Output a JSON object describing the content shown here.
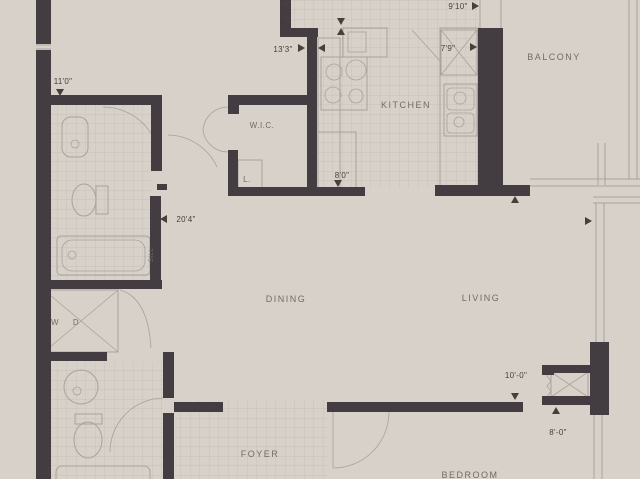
{
  "title": "Apartment floor plan",
  "colors": {
    "background": "#d7d1ca",
    "wall": "#433d41",
    "fixture_line": "#a9a29b",
    "tile_line": "#c3bcb4",
    "room_text": "#716b64",
    "dimension_text": "#46403c"
  },
  "rooms": {
    "kitchen": "KITCHEN",
    "balcony": "BALCONY",
    "wic": "W.I.C.",
    "linen": "L.",
    "dining": "DINING",
    "living": "LIVING",
    "foyer": "FOYER",
    "bedroom": "BEDROOM",
    "washer": "W",
    "dryer": "D",
    "sill": "SILL"
  },
  "dimensions": {
    "bath_width": "11'0\"",
    "kitchen_length": "13'3\"",
    "balcony_width": "9'10\"",
    "kitchen_upper": "7'9\"",
    "kitchen_width": "8'0\"",
    "great_room_length": "20'4\"",
    "bedroom_width": "10'-0\"",
    "bedroom_depth": "8'-0\""
  }
}
